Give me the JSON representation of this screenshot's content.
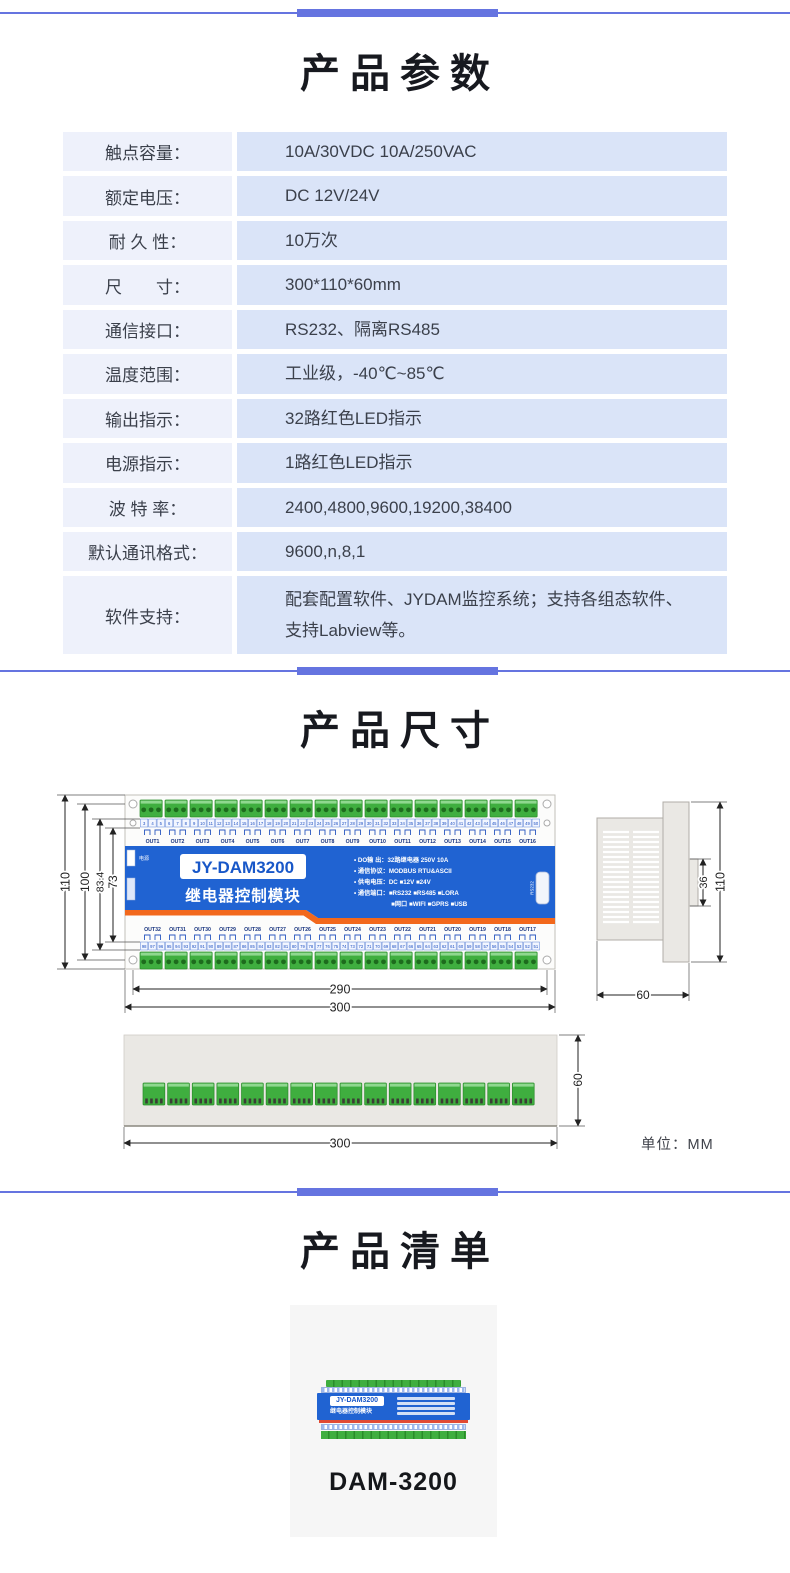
{
  "theme": {
    "divider_blue": "#6574e0",
    "panel_blue": "#2063d2",
    "accent_orange": "#f2681c",
    "terminal_green": "#3fae3f",
    "label_cell_bg": "#eef1fb",
    "value_cell_bg": "#dae4f8",
    "card_bg": "#f6f6f6",
    "text_dark": "#3b404b",
    "title_color": "#17191f"
  },
  "params_section": {
    "title": "产品参数",
    "rows": [
      {
        "label": "触点容量：",
        "value": "10A/30VDC 10A/250VAC"
      },
      {
        "label": "额定电压：",
        "value": "DC 12V/24V"
      },
      {
        "label": "耐 久 性：",
        "value": "10万次"
      },
      {
        "label": "尺　　寸：",
        "value": "300*110*60mm"
      },
      {
        "label": "通信接口：",
        "value": "RS232、隔离RS485"
      },
      {
        "label": "温度范围：",
        "value": "工业级，-40℃~85℃"
      },
      {
        "label": "输出指示：",
        "value": "32路红色LED指示"
      },
      {
        "label": "电源指示：",
        "value": "1路红色LED指示"
      },
      {
        "label": "波 特 率：",
        "value": "2400,4800,9600,19200,38400"
      },
      {
        "label": "默认通讯格式：",
        "value": "9600,n,8,1"
      },
      {
        "label": "软件支持：",
        "value": "配套配置软件、JYDAM监控系统；支持各组态软件、支持Labview等。"
      }
    ]
  },
  "dims_section": {
    "title": "产品尺寸",
    "unit_note": "单位：MM",
    "front_view": {
      "model": "JY-DAM3200",
      "subtitle": "继电器控制模块",
      "power_label": "电源",
      "rs232_label": "RS232",
      "spec_lines": [
        "• DO输 出：32路继电器 250V 10A",
        "• 通信协议：MODBUS RTU&ASCII",
        "• 供电电压：DC ■12V ■24V",
        "• 通信端口：■RS232 ■RS485 ■LORA",
        "　　　　　　■网口 ■WIFI ■GPRS ■USB"
      ],
      "top_out_labels": [
        "OUT1",
        "OUT2",
        "OUT3",
        "OUT4",
        "OUT5",
        "OUT6",
        "OUT7",
        "OUT8",
        "OUT9",
        "OUT10",
        "OUT11",
        "OUT12",
        "OUT13",
        "OUT14",
        "OUT15",
        "OUT16"
      ],
      "bottom_out_labels": [
        "OUT32",
        "OUT31",
        "OUT30",
        "OUT29",
        "OUT28",
        "OUT27",
        "OUT26",
        "OUT25",
        "OUT24",
        "OUT23",
        "OUT22",
        "OUT21",
        "OUT20",
        "OUT19",
        "OUT18",
        "OUT17"
      ],
      "top_terminal_numbers": {
        "from": 3,
        "to": 50
      },
      "bottom_terminal_numbers": {
        "from": 98,
        "to": 51
      },
      "dim_labels": {
        "total_height": "110",
        "inner_height": "100",
        "mid_height": "83.4",
        "relay_span": "73",
        "hole_span": "290",
        "total_width": "300"
      }
    },
    "side_view": {
      "dim_labels": {
        "height": "110",
        "rail_notch": "36",
        "depth": "60"
      }
    },
    "bottom_view": {
      "dim_labels": {
        "depth": "60",
        "width": "300"
      }
    }
  },
  "checklist_section": {
    "title": "产品清单",
    "product_name": "DAM-3200",
    "thumb": {
      "model": "JY-DAM3200",
      "subtitle": "继电器控制模块"
    }
  }
}
